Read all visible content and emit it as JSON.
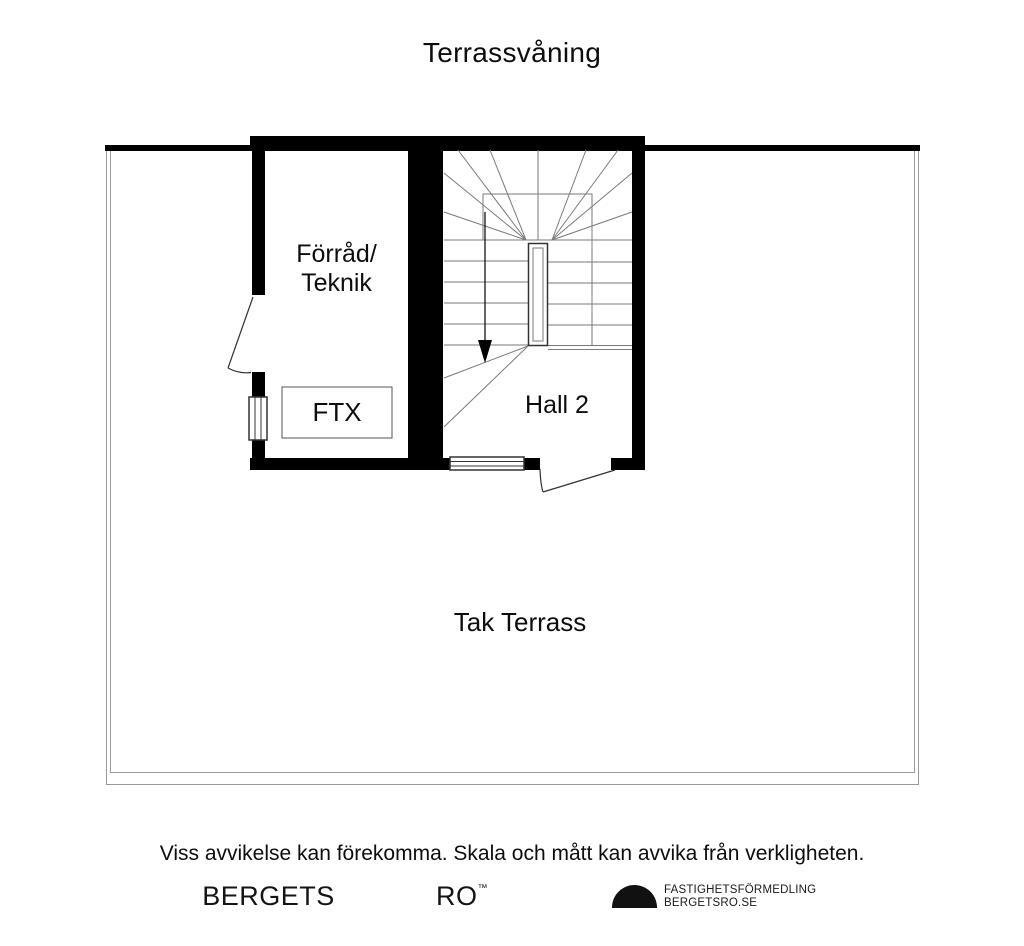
{
  "title": "Terrassvåning",
  "rooms": {
    "storage": {
      "label": "Förråd/\nTeknik"
    },
    "ftx": {
      "label": "FTX"
    },
    "hall": {
      "label": "Hall 2"
    },
    "terrace": {
      "label": "Tak Terrass"
    }
  },
  "stairs": {
    "direction": "down-arrow"
  },
  "footer": {
    "disclaimer": "Viss avvikelse kan förekomma. Skala och mått kan avvika från verkligheten.",
    "brand_left": "BERGETS",
    "brand_right": "RO",
    "brand_trademark": "™",
    "agency_line1": "FASTIGHETSFÖRMEDLING",
    "agency_line2": "BERGETSRO.SE"
  },
  "colors": {
    "wall": "#000000",
    "background": "#ffffff",
    "stair_line": "#7a7a7a",
    "terrace_line": "#999999",
    "fixture_line": "#333333",
    "text": "#0d0d0d"
  }
}
